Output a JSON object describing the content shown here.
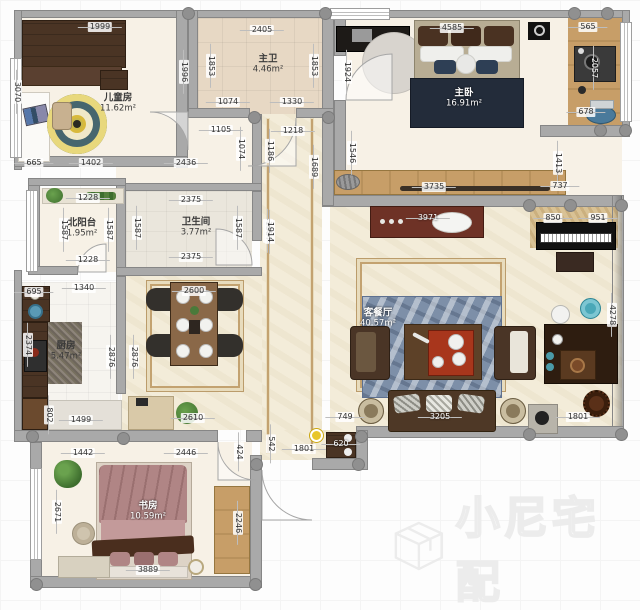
{
  "watermark": {
    "text": "小尼宅配",
    "logo": "cube-logo-icon"
  },
  "palette": {
    "wall": "#a9a9a9",
    "marble_floor": "#f3ecd9",
    "tan_tile": "#e7d8c4",
    "wood": "#c79e68",
    "dark_wood": "#4a3424",
    "navy_blanket": "#232c3a",
    "blue_rug": "#7d8fa8",
    "yellow_rug": "#d8b93c",
    "accent_teal": "#4aa8b8",
    "entry_marker": "#e8c62c"
  },
  "rooms": [
    {
      "id": "kids-room",
      "name": "儿童房",
      "area": "11.62m²",
      "x": 118,
      "y": 103
    },
    {
      "id": "master-bath",
      "name": "主卫",
      "area": "4.46m²",
      "x": 268,
      "y": 64
    },
    {
      "id": "master-bedroom",
      "name": "主卧",
      "area": "16.91m²",
      "x": 464,
      "y": 98,
      "light": true
    },
    {
      "id": "north-balcony",
      "name": "北阳台",
      "area": "1.95m²",
      "x": 82,
      "y": 228
    },
    {
      "id": "bathroom",
      "name": "卫生间",
      "area": "3.77m²",
      "x": 196,
      "y": 227
    },
    {
      "id": "kitchen",
      "name": "厨房",
      "area": "5.47m²",
      "x": 66,
      "y": 351
    },
    {
      "id": "living-dining",
      "name": "客餐厅",
      "area": "40.57m²",
      "x": 378,
      "y": 318,
      "light": true
    },
    {
      "id": "study",
      "name": "书房",
      "area": "10.59m²",
      "x": 148,
      "y": 511,
      "light": true
    }
  ],
  "dimensions": [
    {
      "v": "1999",
      "x": 100,
      "y": 27,
      "o": "h"
    },
    {
      "v": "2405",
      "x": 262,
      "y": 30,
      "o": "h"
    },
    {
      "v": "4585",
      "x": 452,
      "y": 28,
      "o": "h"
    },
    {
      "v": "565",
      "x": 588,
      "y": 27,
      "o": "h"
    },
    {
      "v": "3070",
      "x": 17,
      "y": 92,
      "o": "v"
    },
    {
      "v": "1996",
      "x": 184,
      "y": 72,
      "o": "v"
    },
    {
      "v": "1853",
      "x": 211,
      "y": 66,
      "o": "v"
    },
    {
      "v": "1853",
      "x": 314,
      "y": 66,
      "o": "v"
    },
    {
      "v": "1924",
      "x": 347,
      "y": 72,
      "o": "v"
    },
    {
      "v": "2057",
      "x": 594,
      "y": 68,
      "o": "v",
      "light": true
    },
    {
      "v": "1074",
      "x": 228,
      "y": 102,
      "o": "h"
    },
    {
      "v": "1330",
      "x": 292,
      "y": 102,
      "o": "h"
    },
    {
      "v": "678",
      "x": 586,
      "y": 112,
      "o": "h"
    },
    {
      "v": "1105",
      "x": 221,
      "y": 130,
      "o": "h"
    },
    {
      "v": "1218",
      "x": 293,
      "y": 131,
      "o": "h"
    },
    {
      "v": "1074",
      "x": 241,
      "y": 149,
      "o": "v"
    },
    {
      "v": "1186",
      "x": 270,
      "y": 151,
      "o": "v"
    },
    {
      "v": "1689",
      "x": 314,
      "y": 167,
      "o": "v"
    },
    {
      "v": "1546",
      "x": 352,
      "y": 153,
      "o": "v"
    },
    {
      "v": "1413",
      "x": 558,
      "y": 163,
      "o": "v"
    },
    {
      "v": "665",
      "x": 34,
      "y": 163,
      "o": "h"
    },
    {
      "v": "1402",
      "x": 91,
      "y": 163,
      "o": "h"
    },
    {
      "v": "2436",
      "x": 186,
      "y": 163,
      "o": "h"
    },
    {
      "v": "3735",
      "x": 434,
      "y": 187,
      "o": "h"
    },
    {
      "v": "737",
      "x": 560,
      "y": 186,
      "o": "h"
    },
    {
      "v": "1228",
      "x": 88,
      "y": 198,
      "o": "h"
    },
    {
      "v": "1587",
      "x": 64,
      "y": 230,
      "o": "v"
    },
    {
      "v": "1587",
      "x": 109,
      "y": 230,
      "o": "v"
    },
    {
      "v": "1587",
      "x": 137,
      "y": 228,
      "o": "v"
    },
    {
      "v": "1587",
      "x": 238,
      "y": 228,
      "o": "v"
    },
    {
      "v": "1587",
      "x": 268,
      "y": 231,
      "o": "v"
    },
    {
      "v": "2375",
      "x": 191,
      "y": 200,
      "o": "h"
    },
    {
      "v": "2375",
      "x": 191,
      "y": 257,
      "o": "h"
    },
    {
      "v": "1914",
      "x": 270,
      "y": 232,
      "o": "v"
    },
    {
      "v": "1228",
      "x": 88,
      "y": 260,
      "o": "h"
    },
    {
      "v": "1340",
      "x": 84,
      "y": 288,
      "o": "h"
    },
    {
      "v": "695",
      "x": 34,
      "y": 292,
      "o": "h"
    },
    {
      "v": "2600",
      "x": 194,
      "y": 291,
      "o": "h"
    },
    {
      "v": "3971",
      "x": 428,
      "y": 218,
      "o": "h",
      "light": true
    },
    {
      "v": "850",
      "x": 553,
      "y": 218,
      "o": "h"
    },
    {
      "v": "951",
      "x": 598,
      "y": 218,
      "o": "h"
    },
    {
      "v": "2374",
      "x": 28,
      "y": 345,
      "o": "v"
    },
    {
      "v": "2876",
      "x": 111,
      "y": 357,
      "o": "v"
    },
    {
      "v": "2876",
      "x": 134,
      "y": 357,
      "o": "v"
    },
    {
      "v": "4278",
      "x": 612,
      "y": 315,
      "o": "v"
    },
    {
      "v": "802",
      "x": 49,
      "y": 415,
      "o": "v"
    },
    {
      "v": "1499",
      "x": 81,
      "y": 420,
      "o": "h"
    },
    {
      "v": "2610",
      "x": 193,
      "y": 418,
      "o": "h"
    },
    {
      "v": "749",
      "x": 345,
      "y": 417,
      "o": "h"
    },
    {
      "v": "3205",
      "x": 440,
      "y": 417,
      "o": "h",
      "light": true
    },
    {
      "v": "1801",
      "x": 578,
      "y": 417,
      "o": "h"
    },
    {
      "v": "620",
      "x": 341,
      "y": 444,
      "o": "h",
      "light": true
    },
    {
      "v": "1801",
      "x": 304,
      "y": 449,
      "o": "h"
    },
    {
      "v": "542",
      "x": 271,
      "y": 444,
      "o": "v"
    },
    {
      "v": "424",
      "x": 239,
      "y": 452,
      "o": "v"
    },
    {
      "v": "1442",
      "x": 83,
      "y": 453,
      "o": "h"
    },
    {
      "v": "2446",
      "x": 186,
      "y": 453,
      "o": "h"
    },
    {
      "v": "2671",
      "x": 57,
      "y": 512,
      "o": "v"
    },
    {
      "v": "2246",
      "x": 238,
      "y": 523,
      "o": "v"
    },
    {
      "v": "3889",
      "x": 148,
      "y": 570,
      "o": "h"
    }
  ]
}
